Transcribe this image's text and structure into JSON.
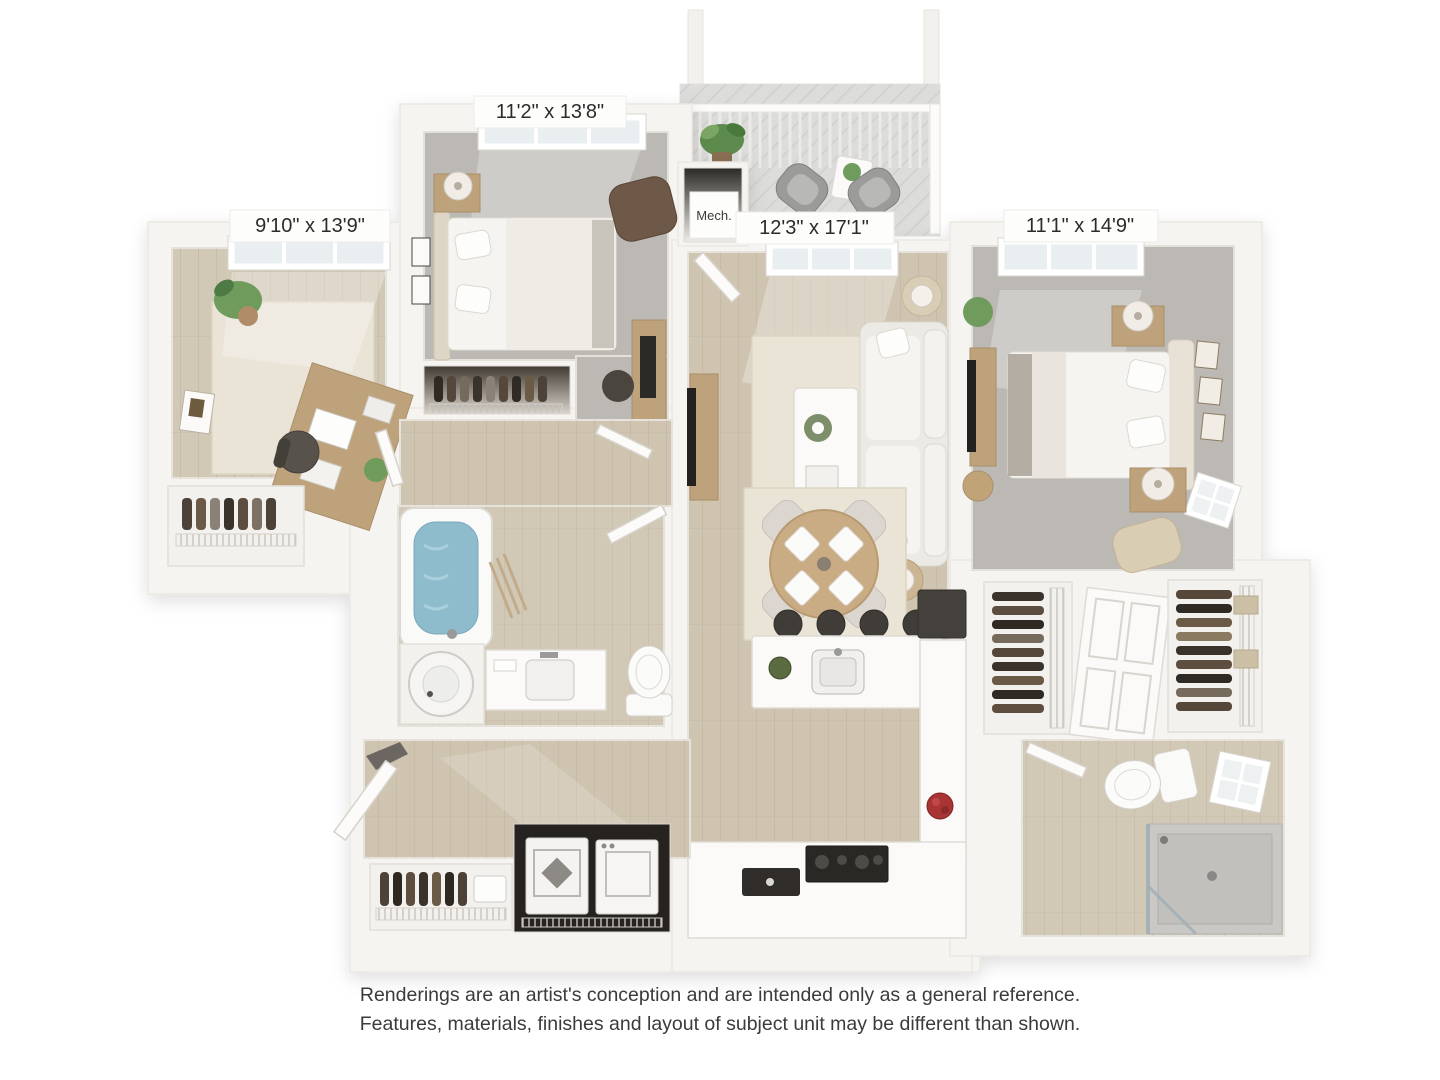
{
  "plan": {
    "labels": {
      "bedroom_top": "11'2\" x 13'8\"",
      "office_left": "9'10\" x 13'9\"",
      "living_center": "12'3\" x 17'1\"",
      "bedroom_right": "11'1\" x 14'9\"",
      "mech_closet": "Mech."
    }
  },
  "disclaimer": {
    "line1": "Renderings are an artist's conception and are intended only as a general reference.",
    "line2": "Features, materials, finishes and layout of subject unit may be different than shown."
  },
  "colors": {
    "background": "#ffffff",
    "wall": "#f6f4f1",
    "wood_floor": "#cfc4b0",
    "carpet": "#bcb9b5",
    "label_text": "#2b2b2b",
    "disclaimer_text": "#3b3b3b",
    "tub_water": "#8fbccd",
    "accent_brown": "#6e5847",
    "stool_dark": "#403d39",
    "pot_red": "#a83434"
  }
}
